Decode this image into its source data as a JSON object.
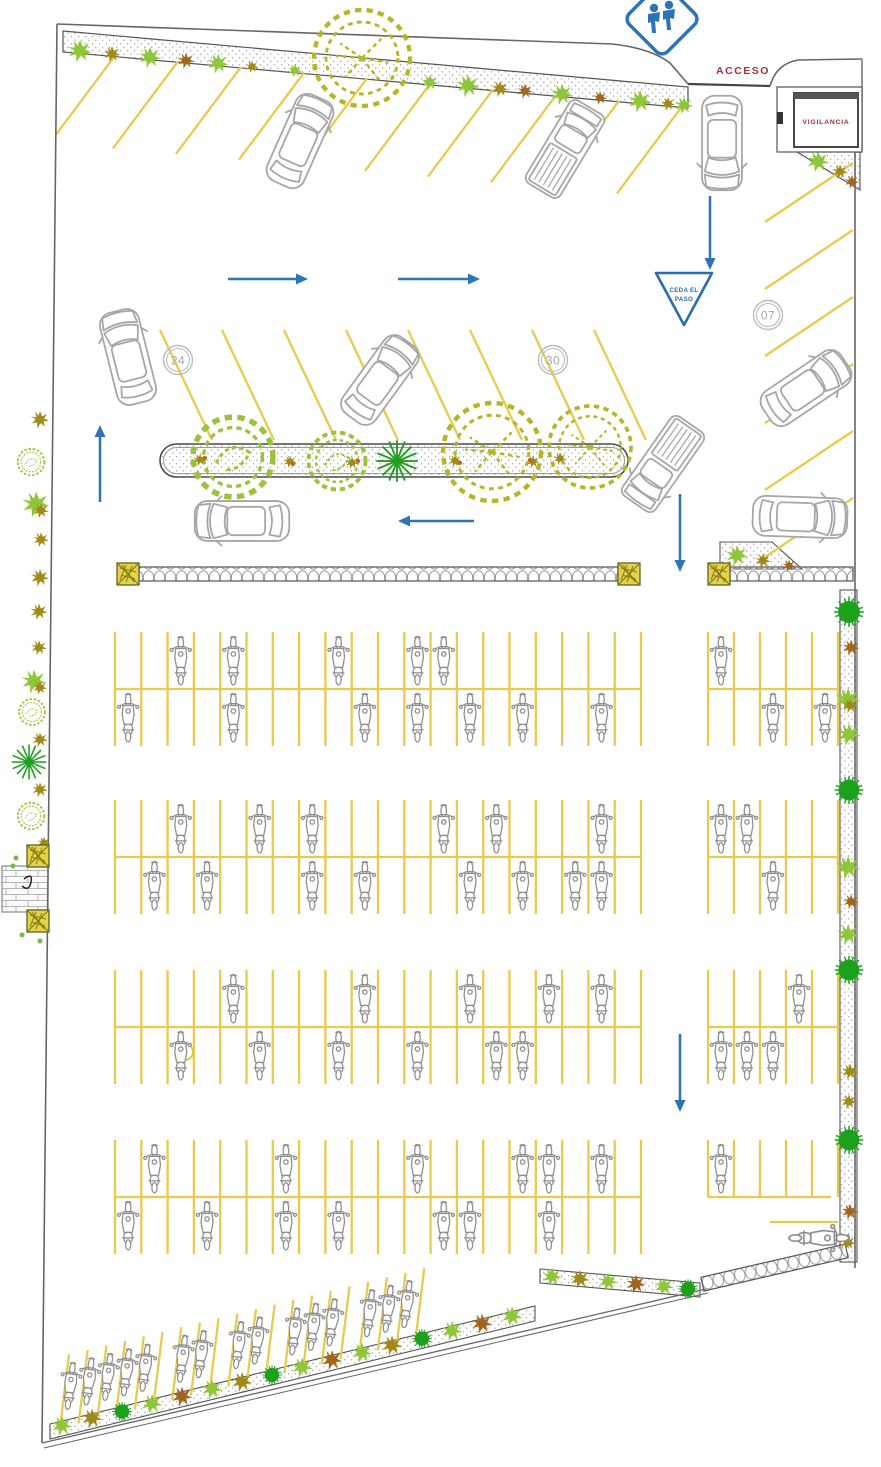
{
  "drawing": {
    "type": "parking-site-plan",
    "language": "es"
  },
  "labels": {
    "access": "ACCESO",
    "surveillance": "VIGILANCIA",
    "yield_line1": "CEDA EL",
    "yield_line2": "PASO",
    "bay_24": "24",
    "bay_30": "30",
    "bay_07": "07"
  },
  "signs": {
    "crossing": "school-crossing-sign",
    "yield": "ceda-el-paso-triangle"
  },
  "colors": {
    "stall_line": "#e7cb4e",
    "arrow_blue": "#2f75b5",
    "label_red": "#a5303c",
    "vehicle_gray": "#a6a6a6",
    "tree_light_green": "#8fc63a",
    "tree_dark_green": "#1da11d",
    "shrub_olive": "#a08a18",
    "shrub_brown": "#a2651f",
    "planter_yellow": "#e6d14a"
  },
  "inventory": {
    "cars": 7,
    "pickup_trucks": 2,
    "motorcycles": 77,
    "motorcycle_stall_blocks": 4,
    "angled_car_stall_rows": 3
  },
  "arrows": {
    "directions": [
      "right",
      "right",
      "down-entry",
      "up",
      "left",
      "down",
      "down"
    ]
  }
}
